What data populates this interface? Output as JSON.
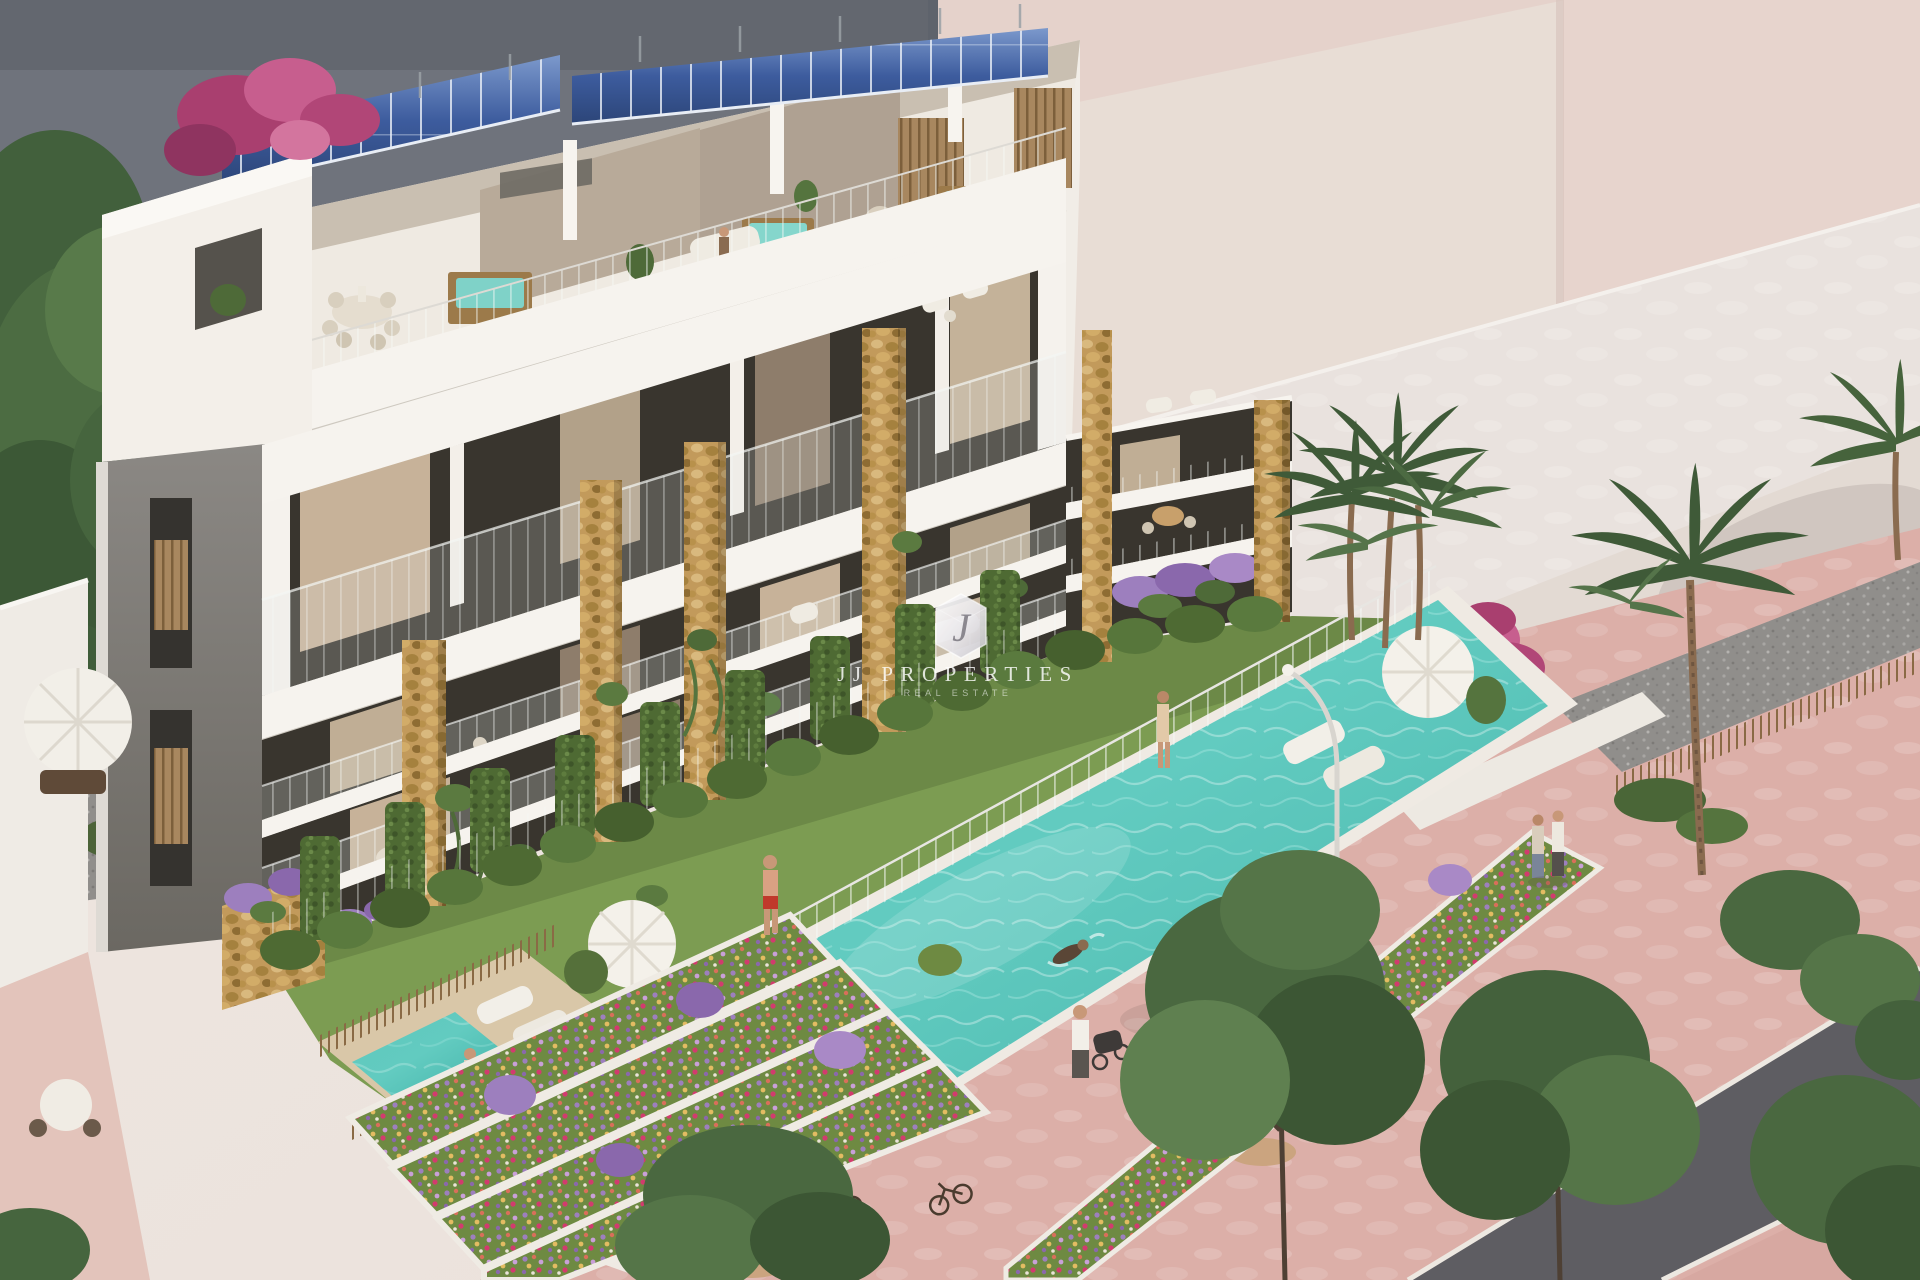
{
  "watermark": {
    "monogram": "J",
    "brand": "JJ PROPERTIES",
    "tagline": "REAL ESTATE"
  },
  "colors": {
    "sky": "#EDE4DE",
    "neighbor_dark": "#6F737C",
    "neighbor_mauve": "#8C7B8A",
    "ghost_light": "#E8DDD5",
    "ghost_roof": "#E9E2DE",
    "ghost_pink": "#E5D2CB",
    "building_white": "#F3EFE9",
    "concrete_gray": "#7E7B76",
    "stone_tan": "#C29A5B",
    "glazing_dark": "#39352E",
    "solar_blue": "#3D5C9E",
    "pool_turquoise": "#5FC8BD",
    "lawn_green": "#7C9C52",
    "hedge_green": "#4E6A33",
    "flower_purple": "#9D7FBE",
    "pavement_pink": "#DCAFA8",
    "road_gray": "#5E5D62",
    "tree_green": "#47613C",
    "gravel_gray": "#908E8B",
    "watermark_white": "#FFFFFF"
  }
}
